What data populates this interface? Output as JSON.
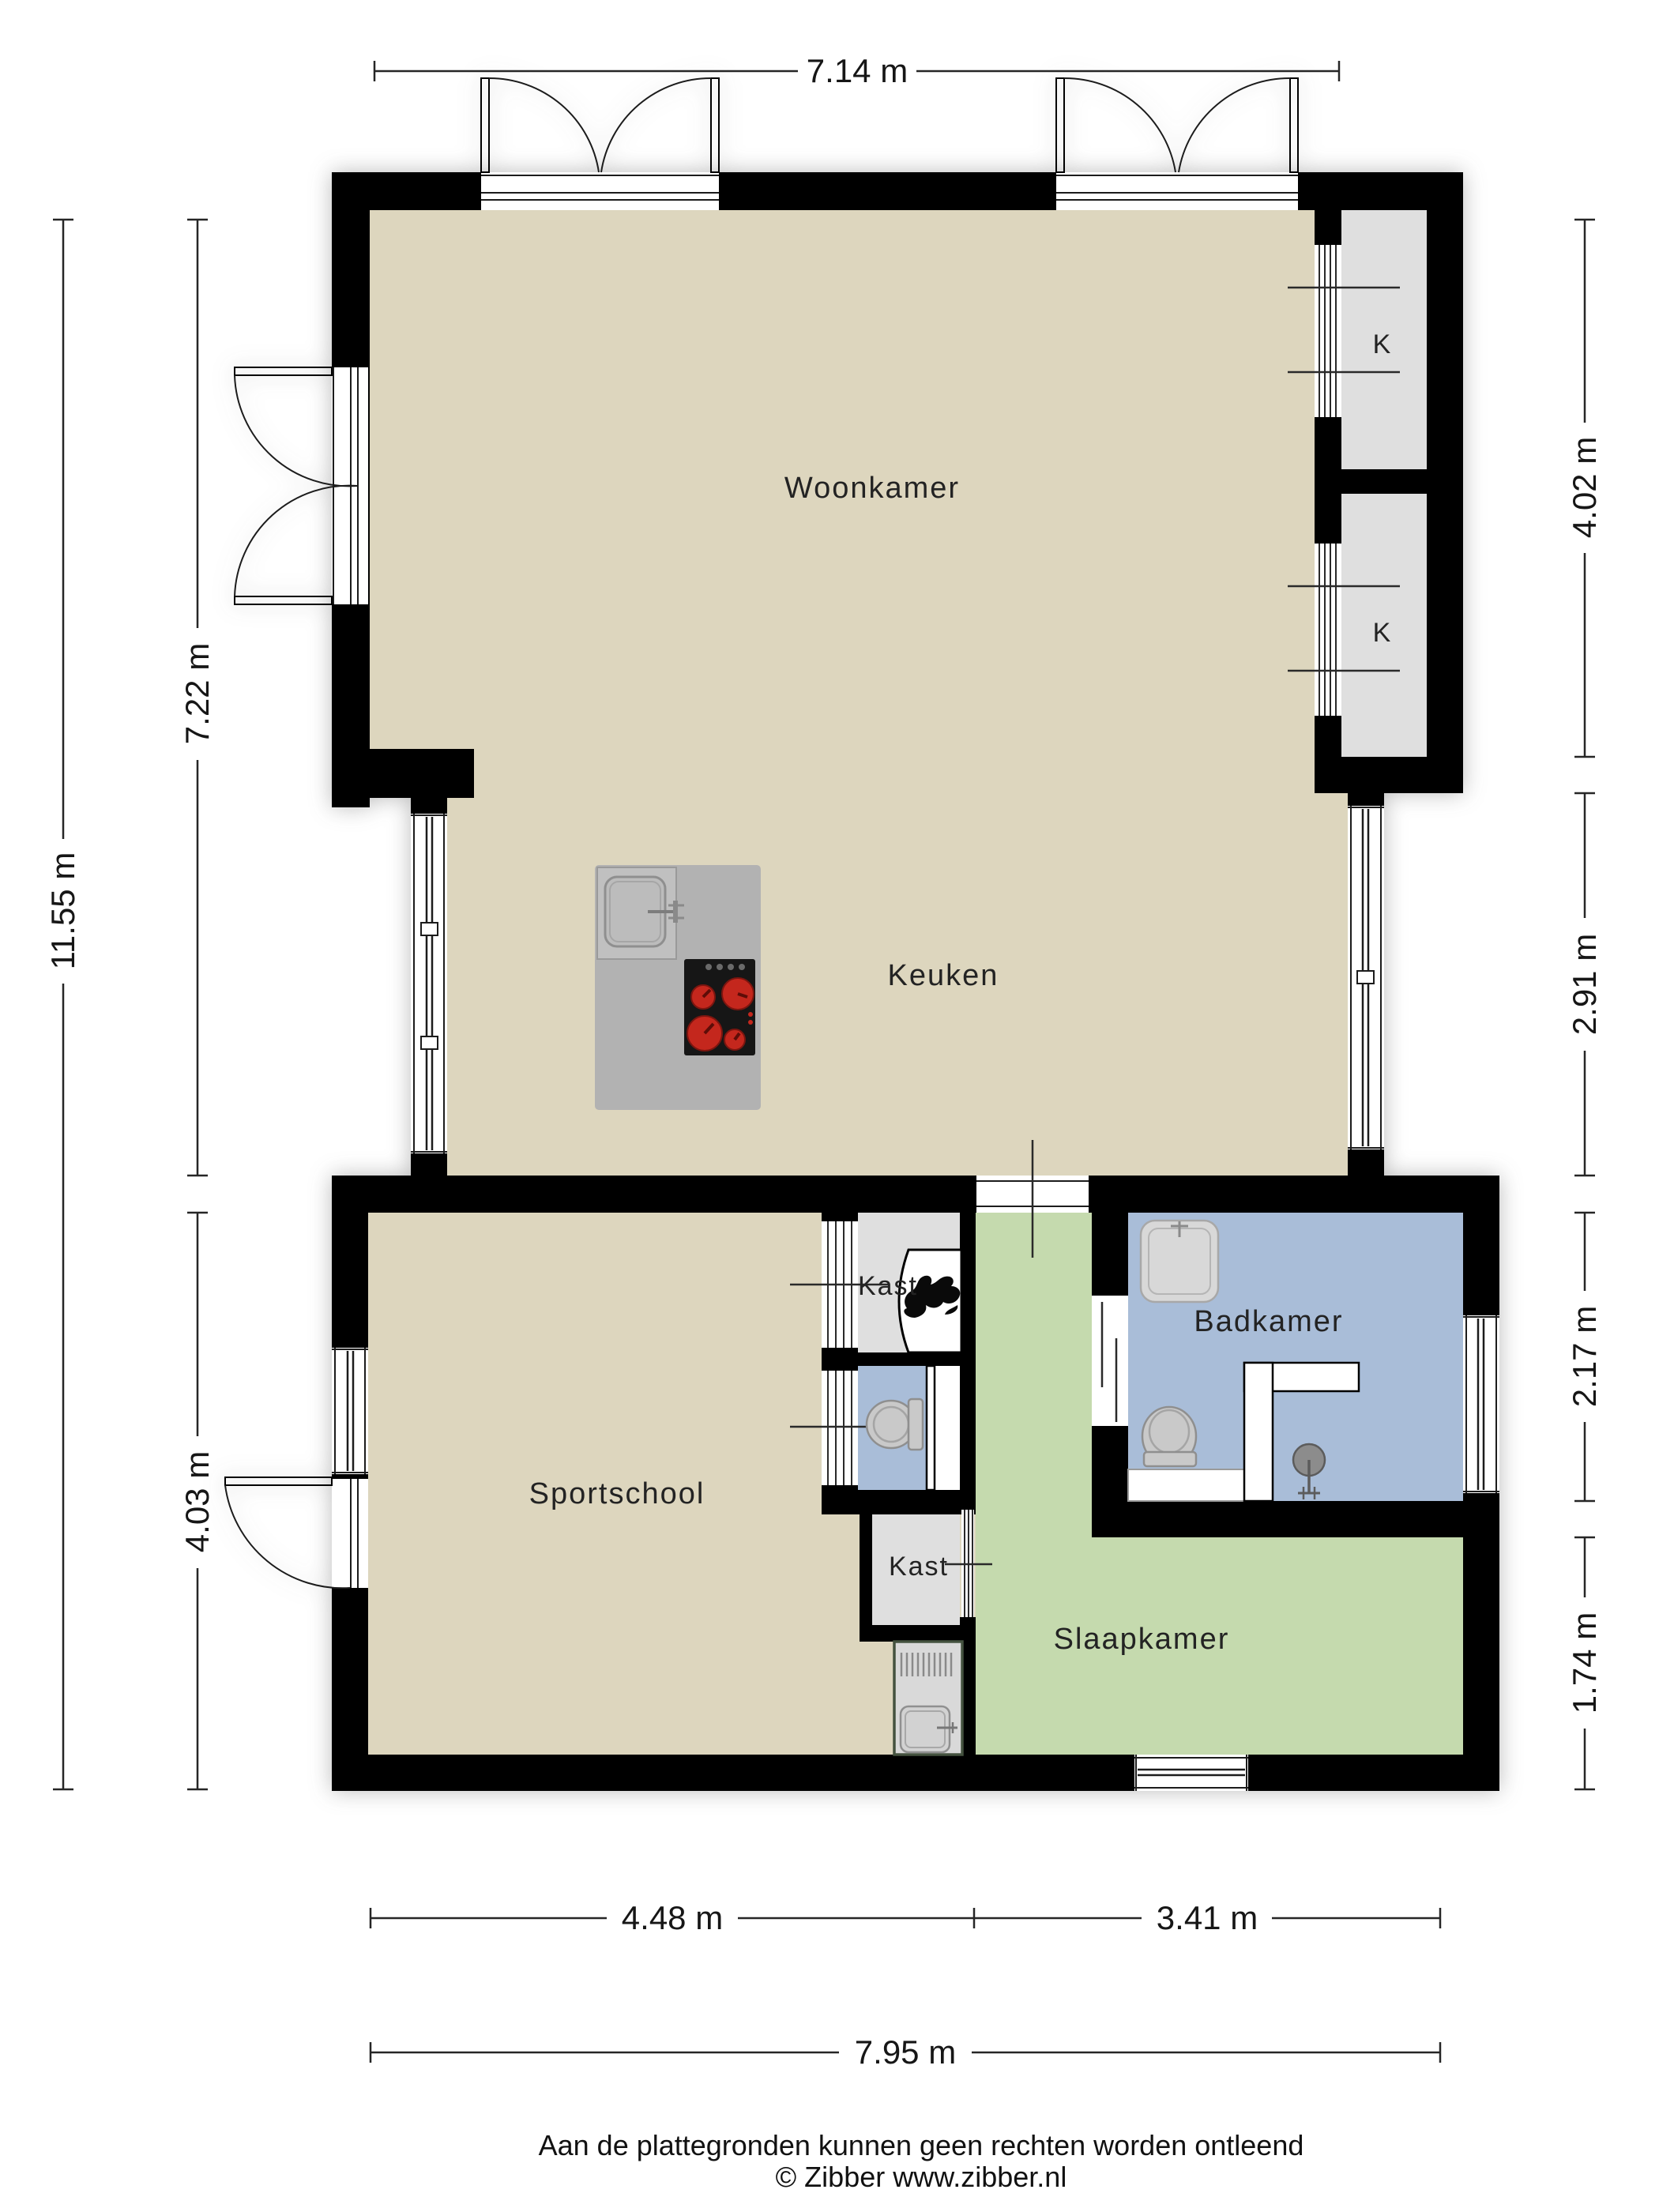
{
  "rooms": {
    "woonkamer": "Woonkamer",
    "keuken": "Keuken",
    "sportschool": "Sportschool",
    "slaapkamer": "Slaapkamer",
    "badkamer": "Badkamer",
    "kast_upper": "Kast",
    "kast_lower": "Kast",
    "closet_k1": "K",
    "closet_k2": "K"
  },
  "dimensions": {
    "top_width": "7.14 m",
    "left_total_height": "11.55 m",
    "left_upper_height": "7.22 m",
    "left_lower_height": "4.03 m",
    "right_closet_height": "4.02 m",
    "right_kitchen_height": "2.91 m",
    "right_bathroom_height": "2.17 m",
    "right_bedroom_height": "1.74 m",
    "bottom_left_width": "4.48 m",
    "bottom_right_width": "3.41 m",
    "bottom_total_width": "7.95 m"
  },
  "footer": {
    "disclaimer": "Aan de plattegronden kunnen geen rechten worden ontleend",
    "copyright": "© Zibber www.zibber.nl"
  },
  "colors": {
    "background": "#ffffff",
    "wall": "#000000",
    "floor_main": "#ddd6be",
    "floor_bedroom": "#c5daae",
    "floor_bathroom": "#a9bdd8",
    "floor_closet": "#dfdfdf",
    "island": "#b2b2b2",
    "cooktop": "#161616",
    "burner": "#c4271d",
    "dimension_text": "#161616",
    "room_text": "#232323"
  },
  "icons": {
    "boiler": "flame-icon",
    "kitchen_sink": "sink-icon",
    "kitchen_cooktop": "cooktop-icon",
    "wc_toilet": "toilet-icon",
    "bathroom_toilet": "toilet-icon",
    "bathroom_washbasin": "washbasin-icon",
    "bathroom_shower": "shower-head-icon",
    "utility_sink": "utility-sink-icon"
  }
}
